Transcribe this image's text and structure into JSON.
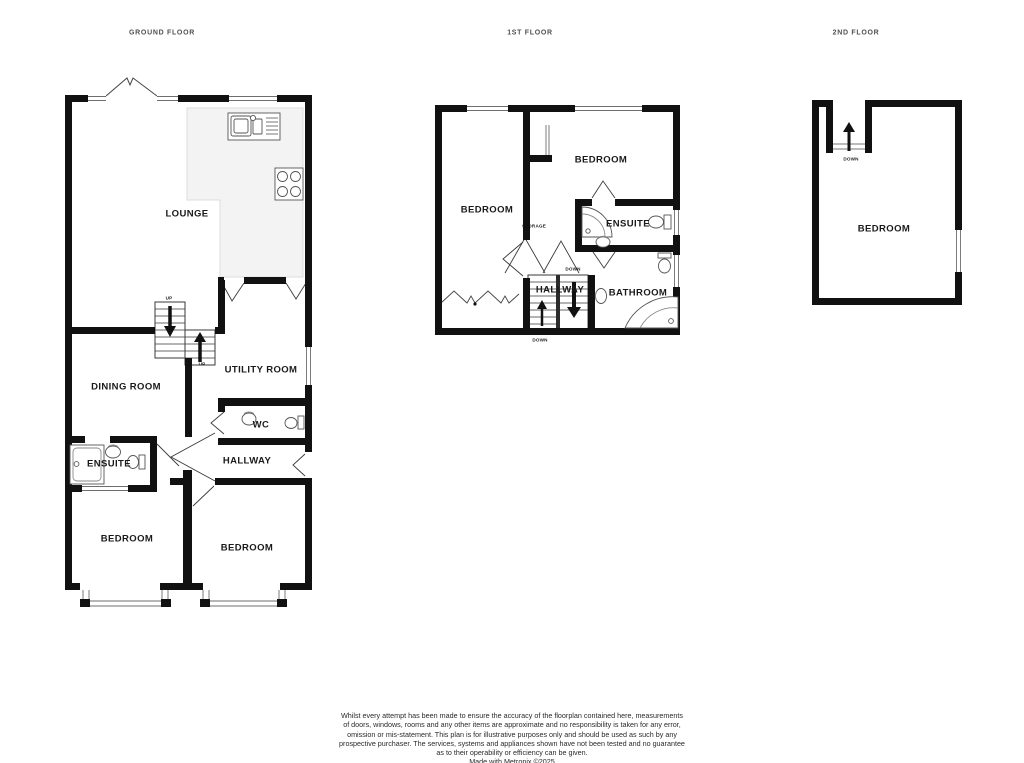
{
  "colors": {
    "background": "#ffffff",
    "wall": "#111111",
    "kitchen_counter": "#f3f3f3",
    "room_label": "#1a1a1a",
    "floor_title": "#4f4f4f",
    "disclaimer_text": "#2a2a2a"
  },
  "floors": {
    "ground": {
      "title": "GROUND FLOOR",
      "rooms": {
        "lounge": "LOUNGE",
        "dining": "DINING ROOM",
        "utility": "UTILITY ROOM",
        "wc": "WC",
        "hallway": "HALLWAY",
        "ensuite": "ENSUITE",
        "bedroom_left": "BEDROOM",
        "bedroom_right": "BEDROOM"
      },
      "stairs": {
        "up1": "UP",
        "up2": "UP"
      },
      "fixtures": [
        "kitchen-sink",
        "hob",
        "shower-cubicle",
        "basin",
        "toilet",
        "basin",
        "toilet",
        "stairs",
        "bay-window",
        "bay-window"
      ]
    },
    "first": {
      "title": "1ST FLOOR",
      "rooms": {
        "bedroom_left": "BEDROOM",
        "bedroom_right": "BEDROOM",
        "storage": "STORAGE",
        "ensuite": "ENSUITE",
        "bathroom": "BATHROOM",
        "hallway": "HALLWAY"
      },
      "stairs": {
        "down1": "DOWN",
        "down2": "DOWN"
      },
      "fixtures": [
        "corner-shower",
        "basin",
        "toilet",
        "corner-shower",
        "basin",
        "toilet",
        "stairs",
        "wardrobe-zigzag"
      ]
    },
    "second": {
      "title": "2ND FLOOR",
      "rooms": {
        "bedroom": "BEDROOM"
      },
      "stairs": {
        "down": "DOWN"
      },
      "fixtures": [
        "stairs"
      ]
    }
  },
  "disclaimer": {
    "lines": [
      "Whilst every attempt has been made to ensure the accuracy of the floorplan contained here, measurements",
      "of doors, windows, rooms and any other items are approximate and no responsibility is taken for any error,",
      "omission or mis-statement. This plan is for illustrative purposes only and should be used as such by any",
      "prospective purchaser. The services, systems and appliances shown have not been tested and no guarantee",
      "as to their operability or efficiency can be given."
    ],
    "credit": "Made with Metropix ©2025"
  }
}
